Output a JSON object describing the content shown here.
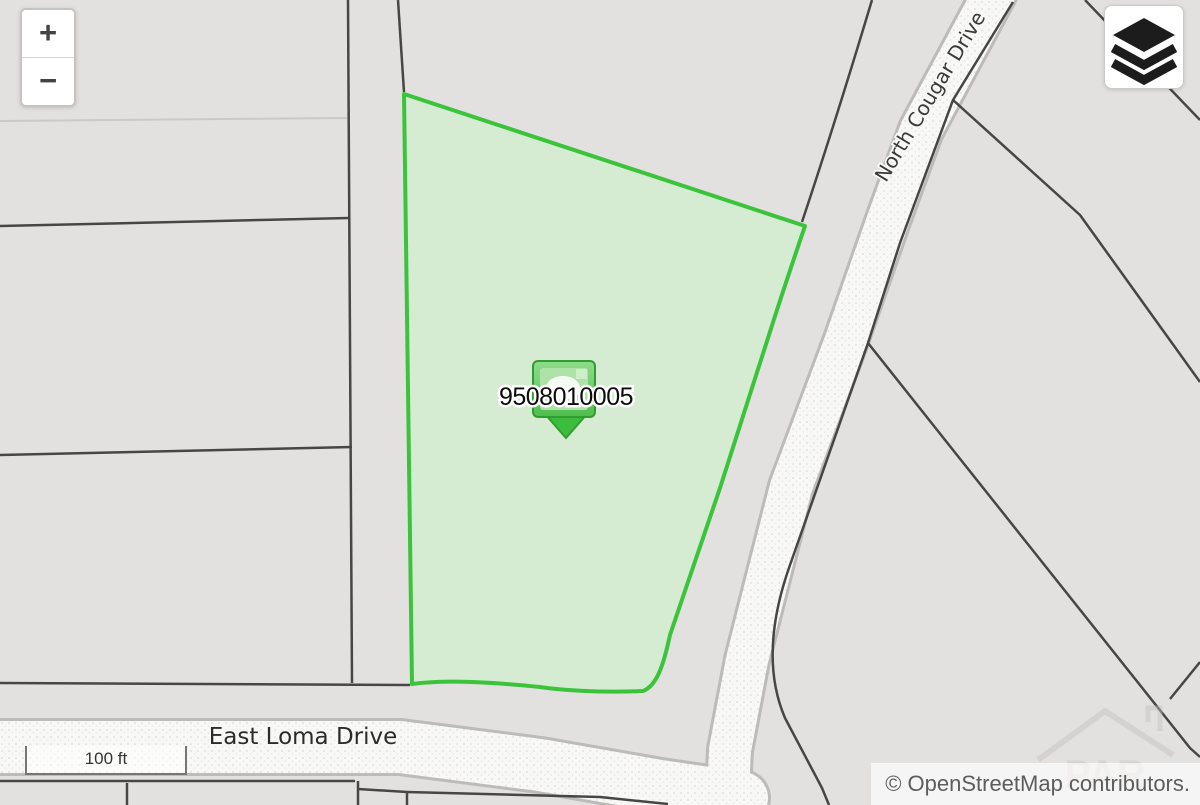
{
  "map": {
    "background_color": "#e3e1e0",
    "parcel": {
      "id": "9508010005",
      "fill": "#d6ecd2",
      "stroke": "#3bc43b"
    },
    "streets": [
      {
        "name": "East Loma Drive"
      },
      {
        "name": "North Cougar Drive"
      }
    ]
  },
  "controls": {
    "zoom_in": "+",
    "zoom_out": "−",
    "scale": "100 ft"
  },
  "attribution": "© OpenStreetMap contributors.",
  "watermark": "PAR"
}
